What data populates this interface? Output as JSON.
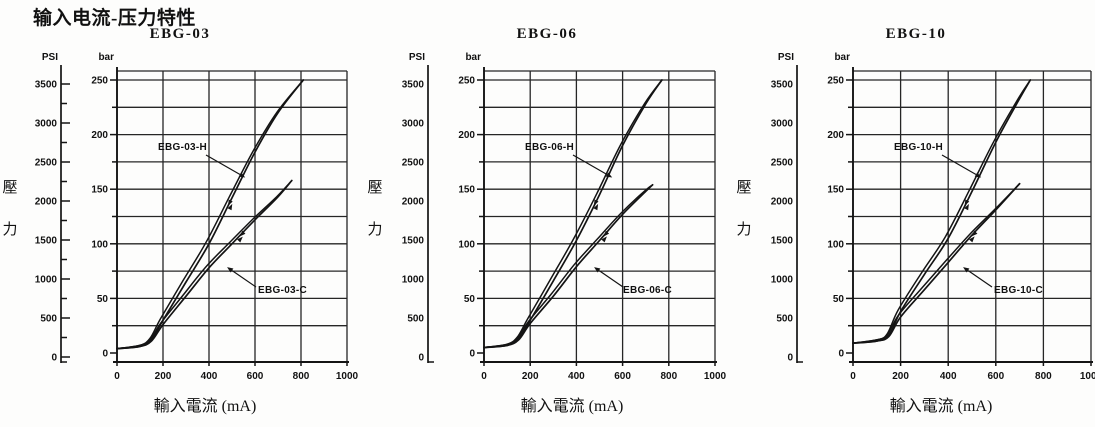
{
  "page": {
    "title": "输入电流-压力特性"
  },
  "labels": {
    "pressure_char_top": "壓",
    "pressure_char_bottom": "力"
  },
  "chart_data": [
    {
      "type": "line",
      "title": "EBG-03",
      "xlabel": "輸入電流 (mA)",
      "ylabel": "壓力",
      "xlim": [
        0,
        1000
      ],
      "x_ticks": [
        0,
        200,
        400,
        600,
        800,
        1000
      ],
      "ylim_bar": [
        0,
        250
      ],
      "y_axes": [
        {
          "name": "PSI",
          "ticks": [
            0,
            500,
            1000,
            1500,
            2000,
            2500,
            3000,
            3500
          ],
          "minor_step": 250,
          "has_tick_marks": true
        },
        {
          "name": "bar",
          "ticks": [
            0,
            50,
            100,
            150,
            200,
            250
          ],
          "minor_step": 25,
          "has_tick_marks": true
        }
      ],
      "grid": {
        "x_step_mA": 200,
        "y_step_bar": 25
      },
      "series": [
        {
          "name": "EBG-03-H",
          "hysteresis": true,
          "points_mA_bar": [
            [
              0,
              4
            ],
            [
              100,
              6
            ],
            [
              150,
              12
            ],
            [
              200,
              30
            ],
            [
              300,
              65
            ],
            [
              400,
              100
            ],
            [
              500,
              142
            ],
            [
              600,
              184
            ],
            [
              700,
              220
            ],
            [
              810,
              250
            ]
          ]
        },
        {
          "name": "EBG-03-C",
          "hysteresis": true,
          "points_mA_bar": [
            [
              0,
              4
            ],
            [
              100,
              6
            ],
            [
              150,
              11
            ],
            [
              200,
              26
            ],
            [
              300,
              52
            ],
            [
              400,
              78
            ],
            [
              500,
              100
            ],
            [
              600,
              122
            ],
            [
              700,
              143
            ],
            [
              760,
              158
            ]
          ]
        }
      ]
    },
    {
      "type": "line",
      "title": "EBG-06",
      "xlabel": "輸入電流 (mA)",
      "ylabel": "壓力",
      "xlim": [
        0,
        1000
      ],
      "x_ticks": [
        0,
        200,
        400,
        600,
        800,
        1000
      ],
      "ylim_bar": [
        0,
        250
      ],
      "y_axes": [
        {
          "name": "PSI",
          "ticks": [
            0,
            500,
            1000,
            1500,
            2000,
            2500,
            3000,
            3500
          ],
          "minor_step": 250,
          "has_tick_marks": false
        },
        {
          "name": "bar",
          "ticks": [
            0,
            50,
            100,
            150,
            200,
            250
          ],
          "minor_step": 25,
          "has_tick_marks": true
        }
      ],
      "grid": {
        "x_step_mA": 200,
        "y_step_bar": 25
      },
      "series": [
        {
          "name": "EBG-06-H",
          "hysteresis": true,
          "points_mA_bar": [
            [
              0,
              5
            ],
            [
              100,
              7
            ],
            [
              150,
              13
            ],
            [
              200,
              30
            ],
            [
              300,
              66
            ],
            [
              400,
              103
            ],
            [
              500,
              145
            ],
            [
              600,
              190
            ],
            [
              700,
              228
            ],
            [
              770,
              250
            ]
          ]
        },
        {
          "name": "EBG-06-C",
          "hysteresis": true,
          "points_mA_bar": [
            [
              0,
              5
            ],
            [
              100,
              7
            ],
            [
              150,
              12
            ],
            [
              200,
              27
            ],
            [
              300,
              52
            ],
            [
              400,
              79
            ],
            [
              500,
              103
            ],
            [
              600,
              127
            ],
            [
              700,
              148
            ],
            [
              730,
              154
            ]
          ]
        }
      ]
    },
    {
      "type": "line",
      "title": "EBG-10",
      "xlabel": "輸入電流 (mA)",
      "ylabel": "壓力",
      "xlim": [
        0,
        1000
      ],
      "x_ticks": [
        0,
        200,
        400,
        600,
        800,
        1000
      ],
      "ylim_bar": [
        0,
        250
      ],
      "y_axes": [
        {
          "name": "PSI",
          "ticks": [
            0,
            500,
            1000,
            1500,
            2000,
            2500,
            3000,
            3500
          ],
          "minor_step": 250,
          "has_tick_marks": false
        },
        {
          "name": "bar",
          "ticks": [
            0,
            50,
            100,
            150,
            200,
            250
          ],
          "minor_step": 25,
          "has_tick_marks": true
        }
      ],
      "grid": {
        "x_step_mA": 200,
        "y_step_bar": 25
      },
      "series": [
        {
          "name": "EBG-10-H",
          "hysteresis": true,
          "points_mA_bar": [
            [
              0,
              9
            ],
            [
              100,
              11
            ],
            [
              150,
              16
            ],
            [
              200,
              38
            ],
            [
              300,
              72
            ],
            [
              400,
              105
            ],
            [
              500,
              148
            ],
            [
              600,
              193
            ],
            [
              700,
              233
            ],
            [
              745,
              250
            ]
          ]
        },
        {
          "name": "EBG-10-C",
          "hysteresis": true,
          "points_mA_bar": [
            [
              0,
              9
            ],
            [
              100,
              11
            ],
            [
              150,
              15
            ],
            [
              200,
              33
            ],
            [
              300,
              58
            ],
            [
              400,
              83
            ],
            [
              500,
              108
            ],
            [
              600,
              131
            ],
            [
              700,
              155
            ]
          ]
        }
      ]
    }
  ]
}
